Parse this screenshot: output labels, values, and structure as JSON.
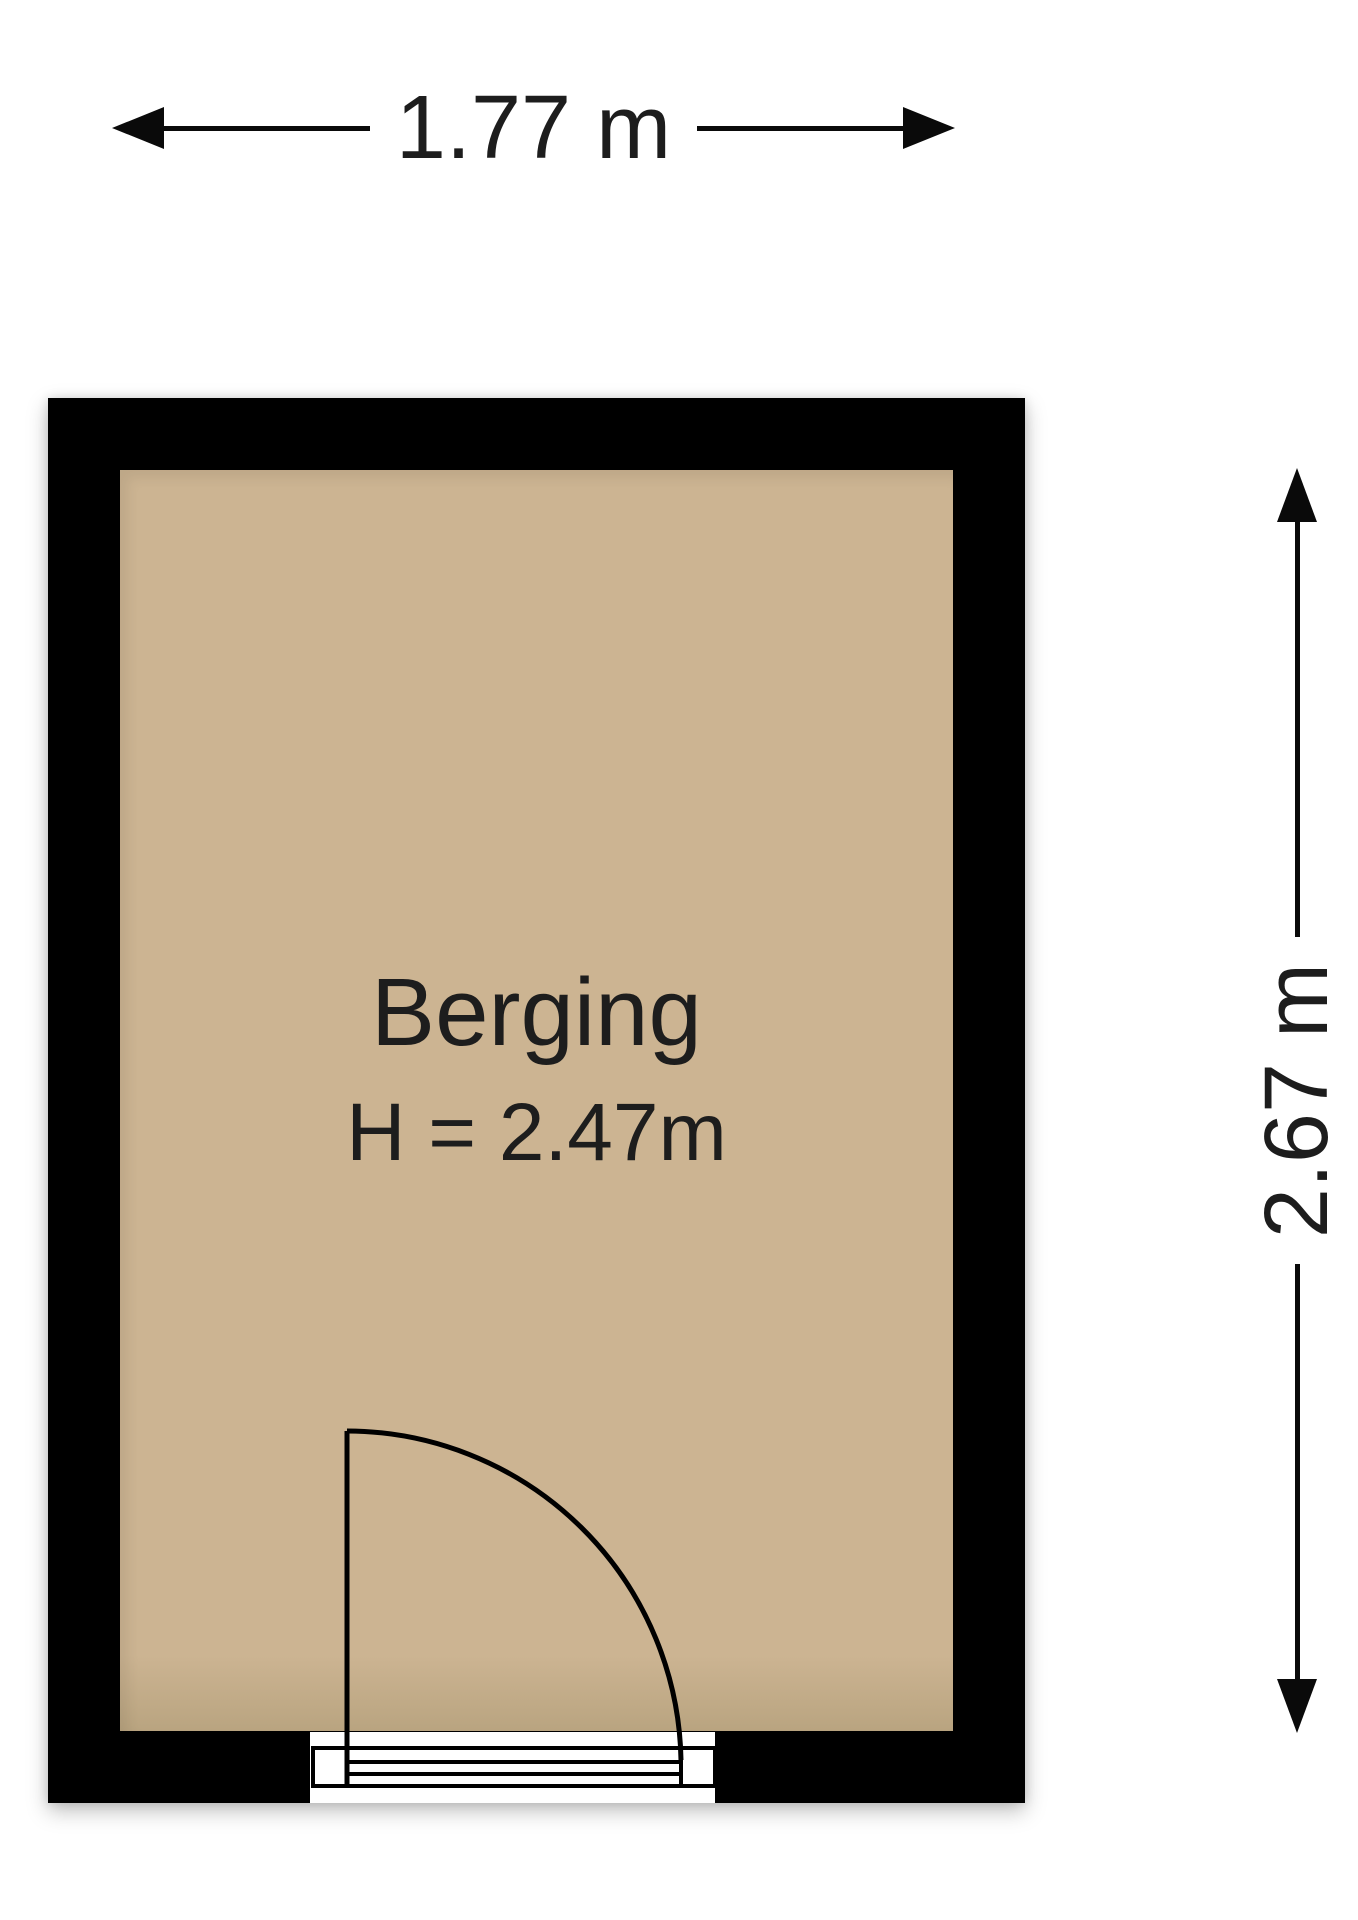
{
  "floorplan": {
    "dimensions": {
      "width_label": "1.77 m",
      "height_label": "2.67 m",
      "width_m": 1.77,
      "height_m": 2.67
    },
    "room": {
      "name": "Berging",
      "ceiling_height_label": "H = 2.47m",
      "ceiling_height_m": 2.47
    },
    "colors": {
      "floor": "#ccb492",
      "floor-dark": "#b9a480",
      "wall": "#000000",
      "line": "#0a0a0a",
      "text": "#1d1d1d",
      "background": "#ffffff"
    }
  }
}
